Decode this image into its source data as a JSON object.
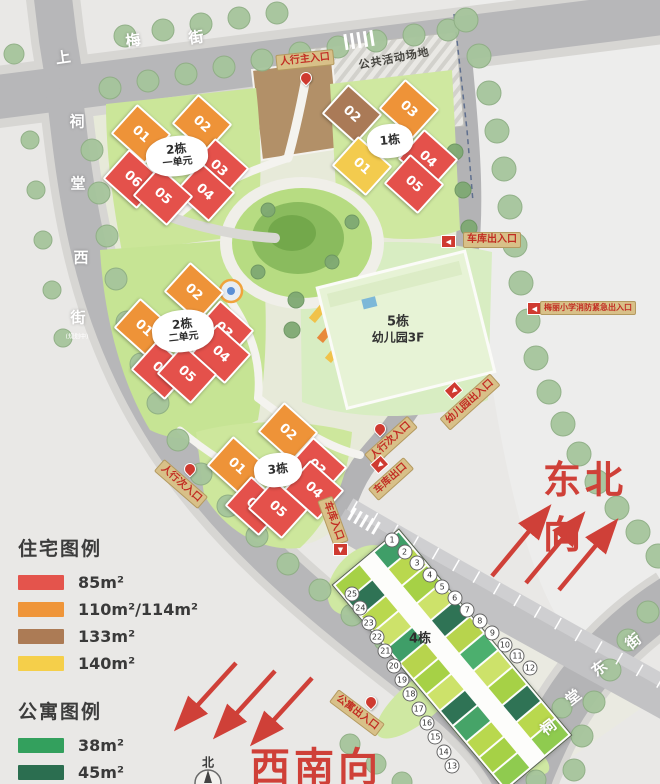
{
  "map": {
    "streets": {
      "shangmei": {
        "name": "上梅街",
        "chars": [
          "上",
          "梅",
          "街"
        ]
      },
      "citang_west": {
        "name": "祠堂西街",
        "chars": [
          "祠",
          "堂",
          "西",
          "街"
        ],
        "note": "(规划中)"
      },
      "citang_east": {
        "name": "祠堂东街",
        "chars": [
          "祠",
          "堂",
          "东",
          "街"
        ]
      }
    },
    "areas": {
      "public_activity": "公共活动场地"
    },
    "entrances": {
      "main_entrance": "人行主入口",
      "garage_entrance_exit": "车库出入口",
      "school_fire_exit": "梅丽小学消防紧急出入口",
      "kindergarten_entrance": "幼儿园出入口",
      "secondary_entrance_east": "人行次入口",
      "garage_exit": "车库出口",
      "garage_entrance": "车库入口",
      "secondary_entrance_west": "人行次入口",
      "apartment_entrance": "公寓出入口"
    },
    "directions": {
      "northeast": "东北向",
      "southwest": "西南向",
      "compass_north": "北"
    }
  },
  "buildings": {
    "b1": {
      "name": "1栋",
      "units": [
        "01",
        "02",
        "03",
        "04",
        "05"
      ]
    },
    "b2u1": {
      "name": "2栋",
      "sub": "一单元",
      "units": [
        "01",
        "02",
        "03",
        "04",
        "05",
        "06"
      ]
    },
    "b2u2": {
      "name": "2栋",
      "sub": "二单元",
      "units": [
        "01",
        "02",
        "03",
        "04",
        "05",
        "06"
      ]
    },
    "b3": {
      "name": "3栋",
      "units": [
        "01",
        "02",
        "03",
        "04",
        "05",
        "06"
      ]
    },
    "b4": {
      "name": "4栋",
      "unit_numbers": [
        "1",
        "2",
        "3",
        "4",
        "5",
        "6",
        "7",
        "8",
        "9",
        "10",
        "11",
        "12",
        "13",
        "14",
        "15",
        "16",
        "17",
        "18",
        "19",
        "20",
        "21",
        "22",
        "23",
        "24",
        "25"
      ]
    },
    "b5": {
      "name": "5栋",
      "sub": "幼儿园3F"
    }
  },
  "legend": {
    "residential_title": "住宅图例",
    "residential": [
      {
        "label": "85m²",
        "color": "#e4544c"
      },
      {
        "label": "110m²/114m²",
        "color": "#ef9539"
      },
      {
        "label": "133m²",
        "color": "#ac7b55"
      },
      {
        "label": "140m²",
        "color": "#f5cf4a"
      }
    ],
    "apartment_title": "公寓图例",
    "apartment": [
      {
        "label": "38m²",
        "color": "#33a05d"
      },
      {
        "label": "45m²",
        "color": "#2b6e50"
      },
      {
        "label": "50m²",
        "color": "#b9d44e"
      }
    ]
  },
  "accent_colors": {
    "entrance_label_red": "#c22d23",
    "direction_red": "#cf4038",
    "label_bg_tan": "#d8c088"
  }
}
